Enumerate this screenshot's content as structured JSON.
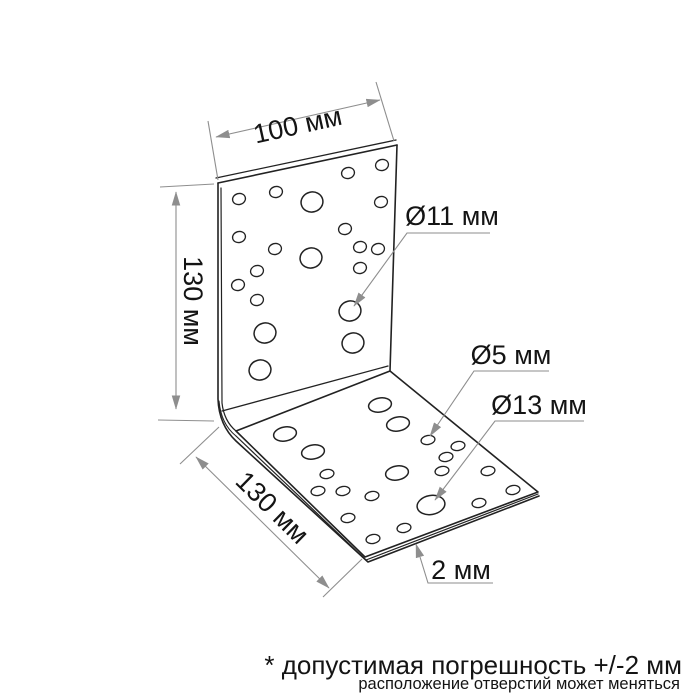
{
  "meta": {
    "background": "#ffffff",
    "canvas_width": 700,
    "canvas_height": 700
  },
  "colors": {
    "outline": "#222222",
    "dimension": "#8e8e8e",
    "text": "#141414",
    "plate_fill": "#ffffff"
  },
  "labels": {
    "width": "100 мм",
    "height": "130 мм",
    "depth": "130 мм",
    "d11": "Ø11 мм",
    "d5": "Ø5 мм",
    "d13": "Ø13 мм",
    "thickness": "2 мм",
    "note_tolerance": "* допустимая погрешность +/-2 мм",
    "note_holes": "расположение отверстий может меняться"
  },
  "drawing": {
    "outline_paths": [
      {
        "name": "plate-top-edge",
        "d": "M 218 183 L 397 145",
        "w": 1.6
      },
      {
        "name": "plate-top-thickness",
        "d": "M 216 178 L 396 140",
        "w": 1.3
      },
      {
        "name": "plate-right-edge",
        "d": "M 397 145 L 390 371",
        "w": 1.6
      },
      {
        "name": "plate-left-outer-silhouette",
        "d": "M 218 183 L 218 399 Q 219 425 236 441 L 368 562 L 539 496",
        "w": 1.6
      },
      {
        "name": "plate-left-inner",
        "d": "M 221 188 L 222 403 Q 224 421 236 431",
        "w": 1.2
      },
      {
        "name": "bend-mid-curve",
        "d": "M 219 401 Q 221 424 236 436",
        "w": 1.1
      },
      {
        "name": "fold-upper-tangent",
        "d": "M 222 411 L 388 366",
        "w": 1.3
      },
      {
        "name": "base-face",
        "d": "M 236 431 L 390 371 L 538 492 L 365 557 Z",
        "w": 1.6
      },
      {
        "name": "base-front-left-mid",
        "d": "M 236 436 L 366 560",
        "w": 1.2
      },
      {
        "name": "base-front-right-mid",
        "d": "M 366 560 L 538 494",
        "w": 1.2
      }
    ],
    "hole_groups": [
      {
        "name": "vertical-plate-small-holes",
        "rx": 6.5,
        "ry": 5.5,
        "rot": -15,
        "w": 1.3,
        "centers": [
          [
            239,
            199
          ],
          [
            276,
            192
          ],
          [
            348,
            173
          ],
          [
            382,
            165
          ],
          [
            381,
            202
          ],
          [
            239,
            237
          ],
          [
            345,
            229
          ],
          [
            360,
            247
          ],
          [
            378,
            249
          ],
          [
            275,
            249
          ],
          [
            257,
            271
          ],
          [
            238,
            285
          ],
          [
            257,
            300
          ],
          [
            360,
            268
          ]
        ]
      },
      {
        "name": "vertical-plate-large-holes",
        "rx": 11,
        "ry": 10,
        "rot": -15,
        "w": 1.5,
        "centers": [
          [
            312,
            202
          ],
          [
            311,
            258
          ],
          [
            265,
            333
          ],
          [
            350,
            311
          ],
          [
            353,
            343
          ],
          [
            260,
            370
          ]
        ]
      },
      {
        "name": "base-plate-small-holes",
        "rx": 7,
        "ry": 4.5,
        "rot": -10,
        "w": 1.3,
        "centers": [
          [
            428,
            440
          ],
          [
            458,
            446
          ],
          [
            446,
            457
          ],
          [
            442,
            471
          ],
          [
            327,
            474
          ],
          [
            318,
            491
          ],
          [
            343,
            491
          ],
          [
            372,
            496
          ],
          [
            488,
            471
          ],
          [
            513,
            490
          ],
          [
            479,
            503
          ],
          [
            348,
            518
          ],
          [
            404,
            528
          ],
          [
            373,
            539
          ]
        ]
      },
      {
        "name": "base-plate-large-holes",
        "rx": 11.5,
        "ry": 7,
        "rot": -10,
        "w": 1.5,
        "centers": [
          [
            380,
            405
          ],
          [
            398,
            424
          ],
          [
            285,
            434
          ],
          [
            313,
            452
          ],
          [
            397,
            473
          ]
        ]
      },
      {
        "name": "base-plate-d13-hole",
        "rx": 14,
        "ry": 9.5,
        "rot": -10,
        "w": 1.5,
        "centers": [
          [
            431,
            505
          ]
        ]
      }
    ],
    "extension_lines": [
      {
        "name": "ext-width-left",
        "x1": 218,
        "y1": 180,
        "x2": 208,
        "y2": 121
      },
      {
        "name": "ext-width-right",
        "x1": 394,
        "y1": 141,
        "x2": 376,
        "y2": 82
      },
      {
        "name": "ext-height-top",
        "x1": 214,
        "y1": 184,
        "x2": 160,
        "y2": 187
      },
      {
        "name": "ext-height-bottom",
        "x1": 214,
        "y1": 421,
        "x2": 158,
        "y2": 420
      },
      {
        "name": "ext-depth-top",
        "x1": 219,
        "y1": 427,
        "x2": 180,
        "y2": 464
      },
      {
        "name": "ext-depth-bottom",
        "x1": 362,
        "y1": 559,
        "x2": 323,
        "y2": 597
      }
    ],
    "dimension_lines": [
      {
        "name": "dim-width",
        "points": "216,137 380,100",
        "bind": "labels.width",
        "label": {
          "x": 298,
          "y": 127,
          "rot": -12.5
        }
      },
      {
        "name": "dim-height",
        "points": "176,192 176,409",
        "bind": "labels.height",
        "label": {
          "x": 191,
          "y": 301,
          "rot": 90
        }
      },
      {
        "name": "dim-depth",
        "points": "196,457 329,588",
        "bind": "labels.depth",
        "label": {
          "x": 271,
          "y": 509,
          "rot": 44.5
        }
      }
    ],
    "leaders": [
      {
        "name": "leader-d11",
        "points": "490,233 407,233 354,306",
        "bind": "labels.d11",
        "label": {
          "x": 452,
          "y": 218,
          "rot": 0
        }
      },
      {
        "name": "leader-d5",
        "points": "549,371 474,371 430,436",
        "bind": "labels.d5",
        "label": {
          "x": 511,
          "y": 357,
          "rot": 0
        }
      },
      {
        "name": "leader-d13",
        "points": "584,421 495,421 435,500",
        "bind": "labels.d13",
        "label": {
          "x": 539,
          "y": 407,
          "rot": 0
        }
      },
      {
        "name": "leader-thickness",
        "points": "493,583 428,583 416,544",
        "bind": "labels.thickness",
        "label": {
          "x": 461,
          "y": 572,
          "rot": 0
        }
      }
    ],
    "notes": [
      {
        "name": "note-tolerance",
        "bind": "labels.note_tolerance",
        "x": 682,
        "y": 674,
        "size": 26
      },
      {
        "name": "note-holes",
        "bind": "labels.note_holes",
        "x": 680,
        "y": 689,
        "size": 16.5
      }
    ],
    "label_font_size": 27
  }
}
